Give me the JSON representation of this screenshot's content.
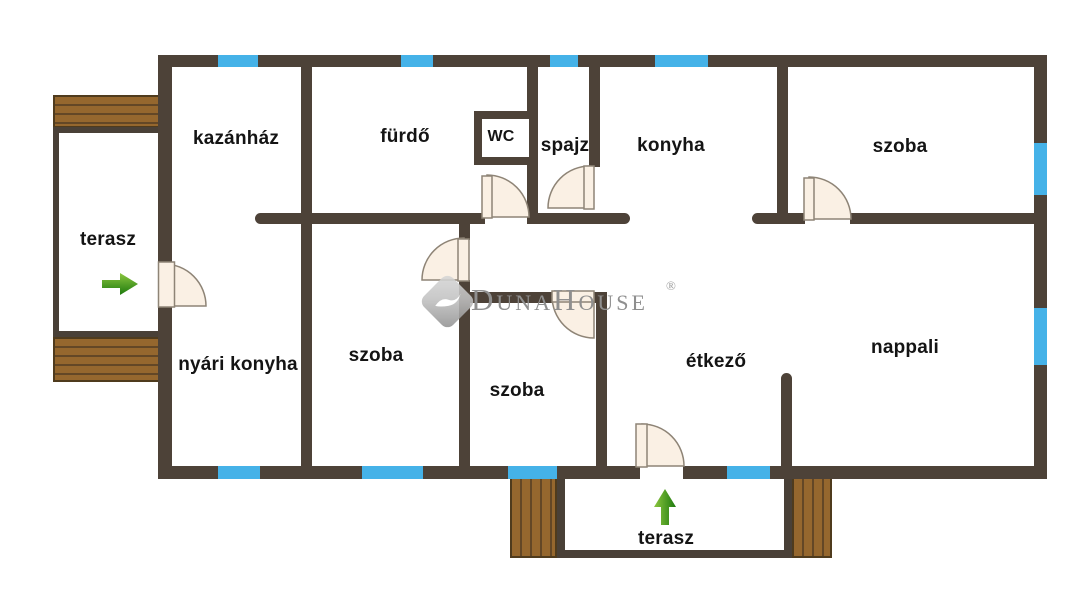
{
  "labels": {
    "kazanhaz": "kazánház",
    "furdo": "fürdő",
    "wc": "WC",
    "spajz": "spajz",
    "konyha": "konyha",
    "szoba_top_right": "szoba",
    "terasz_left": "terasz",
    "nyari_konyha": "nyári konyha",
    "szoba_bottom_left": "szoba",
    "szoba_middle": "szoba",
    "etkezo": "étkező",
    "nappali": "nappali",
    "terasz_bottom": "terasz"
  },
  "watermark": {
    "text": "DunaHouse",
    "registered": "®"
  },
  "icons": {
    "left_terrace_entrance": "green-arrow-right",
    "bottom_terrace_entrance": "green-arrow-up",
    "brand_logo": "dunahouse-diamond"
  },
  "colors": {
    "wall": "#4d4238",
    "window_glass": "#45b2e8",
    "door_leaf": "#faf0e4",
    "wood_deck": "#95672e",
    "arrow_green": "#2e8b12",
    "watermark_gray": "#8f8f8f"
  }
}
